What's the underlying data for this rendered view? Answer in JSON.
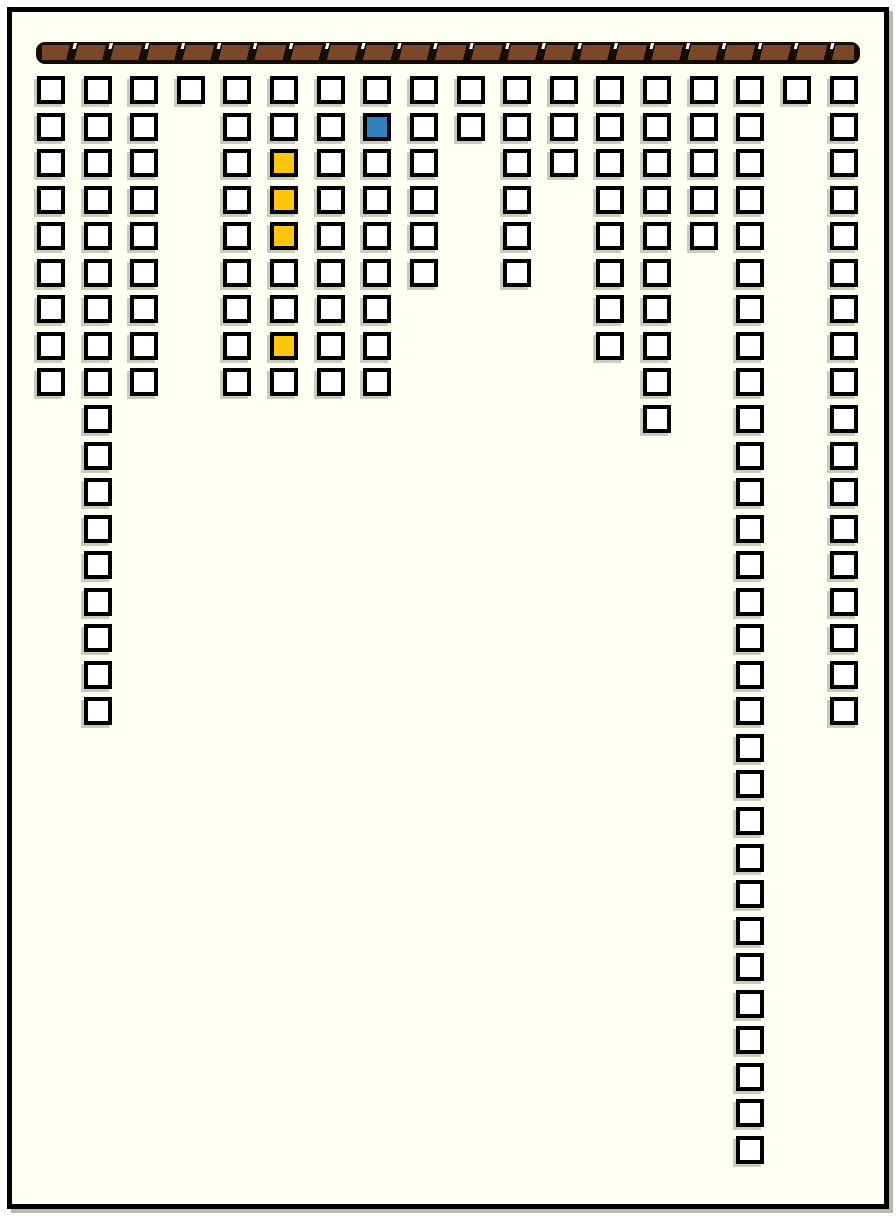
{
  "colors": {
    "canvas_background": "#fffff2",
    "frame_border": "#000000",
    "cell_fill": "#ffffff",
    "cell_border": "#000000",
    "yellow_cell": "#fdc60d",
    "blue_cell": "#2f80bd",
    "rod_base": "#150c06",
    "rod_stripe_brown": "#7b4729",
    "rod_tick_white": "#ffffff"
  },
  "rod": {
    "description": "horizontal striped hanging rod across top of board"
  },
  "board": {
    "state_legend": {
      "w": "white-empty",
      "y": "yellow-marked",
      "b": "blue-marked"
    },
    "column_counts": [
      9,
      18,
      9,
      1,
      9,
      9,
      9,
      9,
      6,
      2,
      6,
      3,
      8,
      10,
      5,
      30,
      1,
      18
    ],
    "highlighted": {
      "yellow_cells": [
        {
          "col": 6,
          "rows": [
            3,
            4,
            5,
            8
          ]
        }
      ],
      "blue_cells": [
        {
          "col": 8,
          "rows": [
            2
          ]
        }
      ]
    },
    "columns": [
      {
        "index": 1,
        "cells": [
          "w",
          "w",
          "w",
          "w",
          "w",
          "w",
          "w",
          "w",
          "w"
        ]
      },
      {
        "index": 2,
        "cells": [
          "w",
          "w",
          "w",
          "w",
          "w",
          "w",
          "w",
          "w",
          "w",
          "w",
          "w",
          "w",
          "w",
          "w",
          "w",
          "w",
          "w",
          "w"
        ]
      },
      {
        "index": 3,
        "cells": [
          "w",
          "w",
          "w",
          "w",
          "w",
          "w",
          "w",
          "w",
          "w"
        ]
      },
      {
        "index": 4,
        "cells": [
          "w"
        ]
      },
      {
        "index": 5,
        "cells": [
          "w",
          "w",
          "w",
          "w",
          "w",
          "w",
          "w",
          "w",
          "w"
        ]
      },
      {
        "index": 6,
        "cells": [
          "w",
          "w",
          "y",
          "y",
          "y",
          "w",
          "w",
          "y",
          "w"
        ]
      },
      {
        "index": 7,
        "cells": [
          "w",
          "w",
          "w",
          "w",
          "w",
          "w",
          "w",
          "w",
          "w"
        ]
      },
      {
        "index": 8,
        "cells": [
          "w",
          "b",
          "w",
          "w",
          "w",
          "w",
          "w",
          "w",
          "w"
        ]
      },
      {
        "index": 9,
        "cells": [
          "w",
          "w",
          "w",
          "w",
          "w",
          "w"
        ]
      },
      {
        "index": 10,
        "cells": [
          "w",
          "w"
        ]
      },
      {
        "index": 11,
        "cells": [
          "w",
          "w",
          "w",
          "w",
          "w",
          "w"
        ]
      },
      {
        "index": 12,
        "cells": [
          "w",
          "w",
          "w"
        ]
      },
      {
        "index": 13,
        "cells": [
          "w",
          "w",
          "w",
          "w",
          "w",
          "w",
          "w",
          "w"
        ]
      },
      {
        "index": 14,
        "cells": [
          "w",
          "w",
          "w",
          "w",
          "w",
          "w",
          "w",
          "w",
          "w",
          "w"
        ]
      },
      {
        "index": 15,
        "cells": [
          "w",
          "w",
          "w",
          "w",
          "w"
        ]
      },
      {
        "index": 16,
        "cells": [
          "w",
          "w",
          "w",
          "w",
          "w",
          "w",
          "w",
          "w",
          "w",
          "w",
          "w",
          "w",
          "w",
          "w",
          "w",
          "w",
          "w",
          "w",
          "w",
          "w",
          "w",
          "w",
          "w",
          "w",
          "w",
          "w",
          "w",
          "w",
          "w",
          "w"
        ]
      },
      {
        "index": 17,
        "cells": [
          "w"
        ]
      },
      {
        "index": 18,
        "cells": [
          "w",
          "w",
          "w",
          "w",
          "w",
          "w",
          "w",
          "w",
          "w",
          "w",
          "w",
          "w",
          "w",
          "w",
          "w",
          "w",
          "w",
          "w"
        ]
      }
    ]
  }
}
